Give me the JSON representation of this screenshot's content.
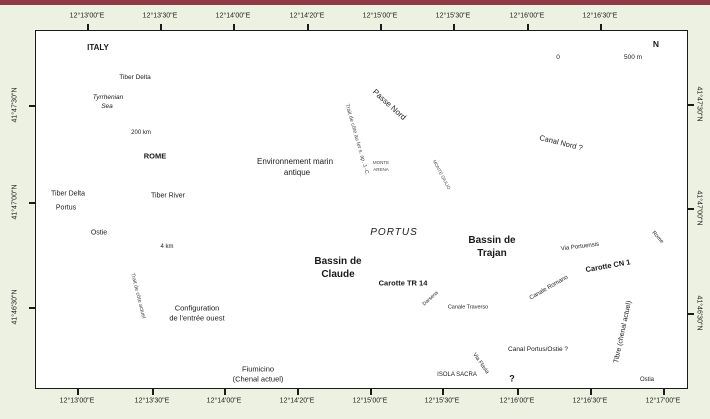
{
  "axis": {
    "top": [
      "12°13'00\"E",
      "12°13'30\"E",
      "12°14'00\"E",
      "12°14'20\"E",
      "12°15'00\"E",
      "12°15'30\"E",
      "12°16'00\"E",
      "12°16'30\"E"
    ],
    "bottom": [
      "12°13'00\"E",
      "12°13'30\"E",
      "12°14'00\"E",
      "12°14'20\"E",
      "12°15'00\"E",
      "12°15'30\"E",
      "12°16'00\"E",
      "12°16'30\"E",
      "12°17'00\"E"
    ],
    "left": [
      "41°47'30\"N",
      "41°47'00\"N",
      "41°46'30\"N"
    ],
    "right": [
      "41°47'30\"N",
      "41°47'00\"N",
      "41°46'30\"N"
    ]
  },
  "inset_italy": {
    "country": "ITALY",
    "marker": "Tiber Delta",
    "sea_line1": "Tyrrhenian",
    "sea_line2": "Sea",
    "scale": "200 km"
  },
  "inset_delta": {
    "city": "ROME",
    "river": "Tiber River",
    "delta": "Tiber Delta",
    "portus": "Portus",
    "ostia": "Ostie",
    "scale": "4 km"
  },
  "labels": {
    "marine_env_1": "Environnement marin",
    "marine_env_2": "antique",
    "passe_nord": "Passe Nord",
    "coast_ancient": "Trait de côte au Ier s. ap. J.-C.",
    "coast_modern": "Trait de côte actuel",
    "monte_arena_1": "MONTE",
    "monte_arena_2": "ARENA",
    "monte_giulio": "MONTE GIULIO",
    "canal_nord": "Canal Nord ?",
    "portus": "PORTUS",
    "bassin_claude_1": "Bassin de",
    "bassin_claude_2": "Claude",
    "bassin_trajan_1": "Bassin de",
    "bassin_trajan_2": "Trajan",
    "carotte_tr": "Carotte TR 14",
    "carotte_cn": "Carotte CN 1",
    "via_portuensis": "Via Portuensis",
    "canale_romano": "Canale Romano",
    "darsena": "Darsena",
    "canale_traverso": "Canale Traverso",
    "canal_portus_ostie": "Canal Portus/Ostie ?",
    "canal_question": "?",
    "via_flavia": "Via Flavia",
    "isola_sacra": "ISOLA SACRA",
    "tibre": "Tibre (chenal actuel)",
    "rome_dir": "Rome",
    "ostia_dir": "Ostia",
    "config_1": "Configuration",
    "config_2": "de l'entrée ouest",
    "mer": "Mer tyrrhénienne",
    "fiumicino_1": "Fiumicino",
    "fiumicino_2": "(Chenal actuel)"
  },
  "scale_bar": {
    "zero": "0",
    "max": "500 m"
  },
  "compass": {
    "n": "N"
  },
  "colors": {
    "top_bar": "#8e3b45",
    "sea": "#5a5fa9",
    "river": "#474c9f",
    "canal": "#a5c3e6",
    "marine": "#b3cae9",
    "structure": "#d7d7d5",
    "core_marker": "#e32119",
    "page_bg": "#edf1e1"
  }
}
